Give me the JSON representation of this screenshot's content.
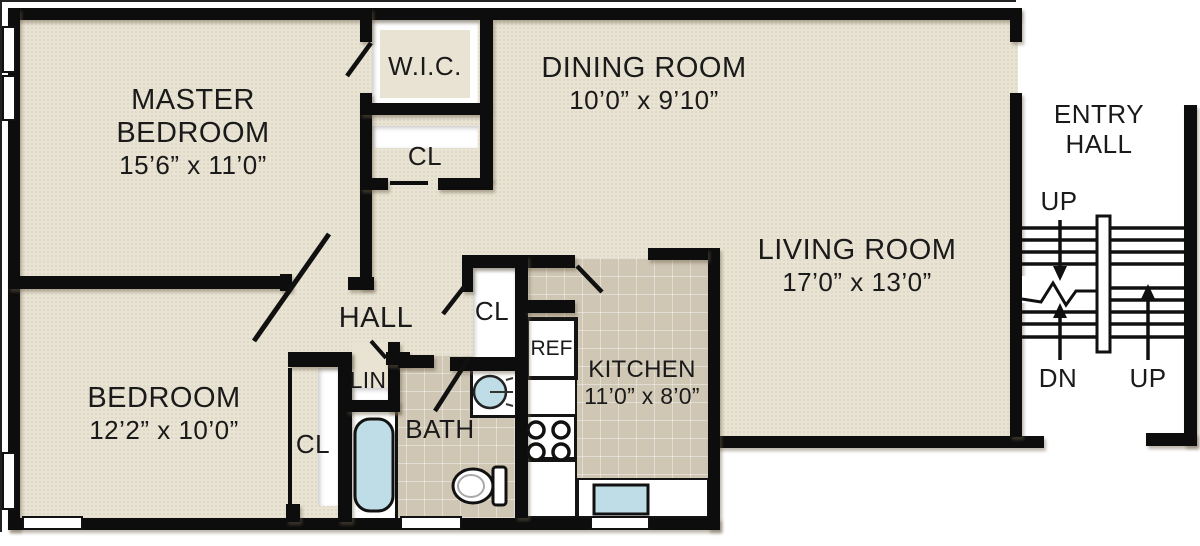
{
  "plan": {
    "rooms": {
      "master_bedroom": {
        "line1": "MASTER",
        "line2": "BEDROOM",
        "dims": "15’6” x 11’0”"
      },
      "dining_room": {
        "name": "DINING ROOM",
        "dims": "10’0” x 9’10”"
      },
      "living_room": {
        "name": "LIVING ROOM",
        "dims": "17’0” x 13’0”"
      },
      "bedroom": {
        "name": "BEDROOM",
        "dims": "12’2” x 10’0”"
      },
      "kitchen": {
        "name": "KITCHEN",
        "dims": "11’0” x 8’0”"
      },
      "entry_hall": {
        "line1": "ENTRY",
        "line2": "HALL"
      },
      "hall": {
        "name": "HALL"
      },
      "bath": {
        "name": "BATH"
      },
      "wic": {
        "name": "W.I.C."
      },
      "lin": {
        "name": "LIN"
      }
    },
    "labels": {
      "closet": "CL",
      "refrigerator": "REF"
    },
    "stairs": {
      "up_upper": "UP",
      "down": "DN",
      "up_lower": "UP"
    },
    "colors": {
      "wall": "#0d0d0d",
      "floor_beige": "#e8e3d3",
      "floor_tile": "#cfc6b4",
      "fixture_water": "#bedde6",
      "text": "#1a1a1a"
    }
  }
}
